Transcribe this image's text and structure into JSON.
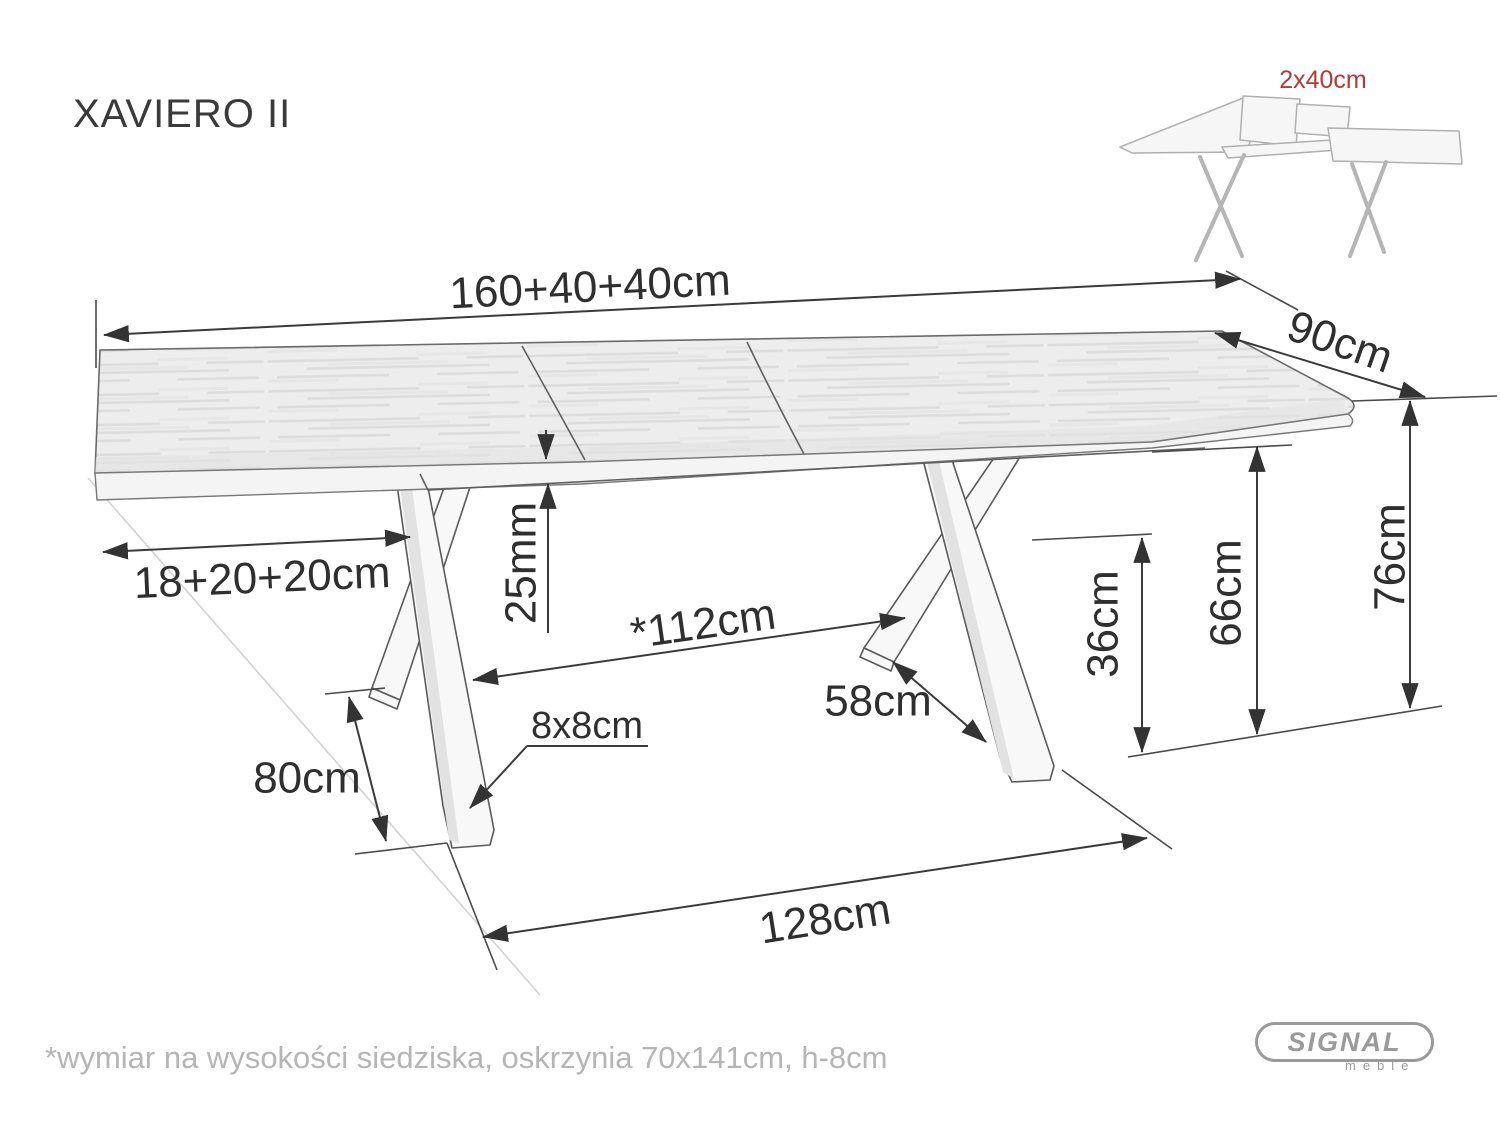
{
  "page": {
    "title": "XAVIERO II",
    "footnote": "*wymiar na wysokości siedziska, oskrzynia 70x141cm, h-8cm"
  },
  "thumbnail": {
    "extension_label": "2x40cm"
  },
  "logo": {
    "name": "SIGNAL",
    "sub": "meble"
  },
  "dimensions": {
    "total_length": "160+40+40cm",
    "depth": "90cm",
    "top_overhang": "18+20+20cm",
    "top_thickness": "25mm",
    "inner_leg_span": "*112cm",
    "foot_spread": "58cm",
    "cross_height": "36cm",
    "clearance_height": "66cm",
    "total_height": "76cm",
    "leg_length": "80cm",
    "leg_section": "8x8cm",
    "base_length": "128cm"
  },
  "colors": {
    "dimension_ink": "#3a3a3a",
    "accent_red": "#b23b36",
    "sketch_gray": "#b0b0b0",
    "logo_gray": "#9a9a9a",
    "wood_fill": "#ededed"
  }
}
